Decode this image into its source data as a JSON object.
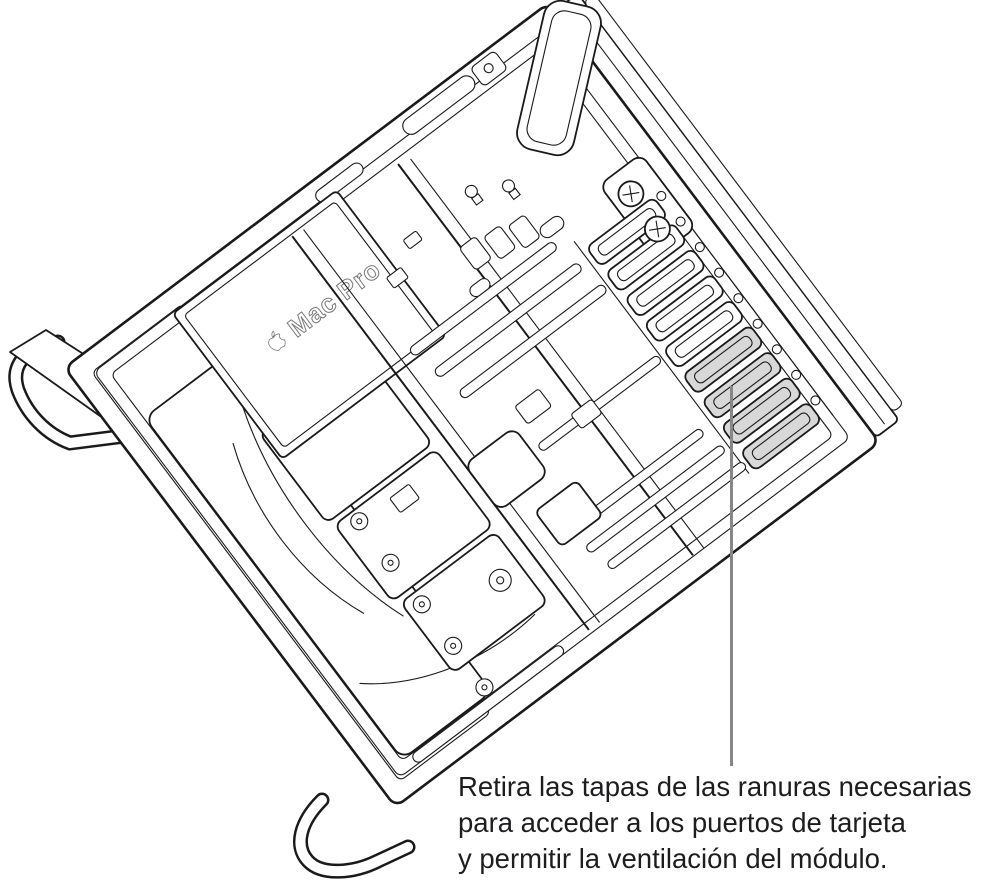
{
  "figure": {
    "device_label": "Mac Pro",
    "caption": {
      "line1": "Retira las tapas de las ranuras necesarias",
      "line2": "para acceder a los puertos de tarjeta",
      "line3": "y permitir la ventilación del módulo."
    },
    "slot_covers": {
      "total": 9,
      "highlighted": 4
    },
    "colors": {
      "background": "#ffffff",
      "line": "#1a1a1a",
      "highlight_fill": "#d8d8d8",
      "callout_line": "#878787",
      "caption_text": "#1d1d1f"
    }
  }
}
